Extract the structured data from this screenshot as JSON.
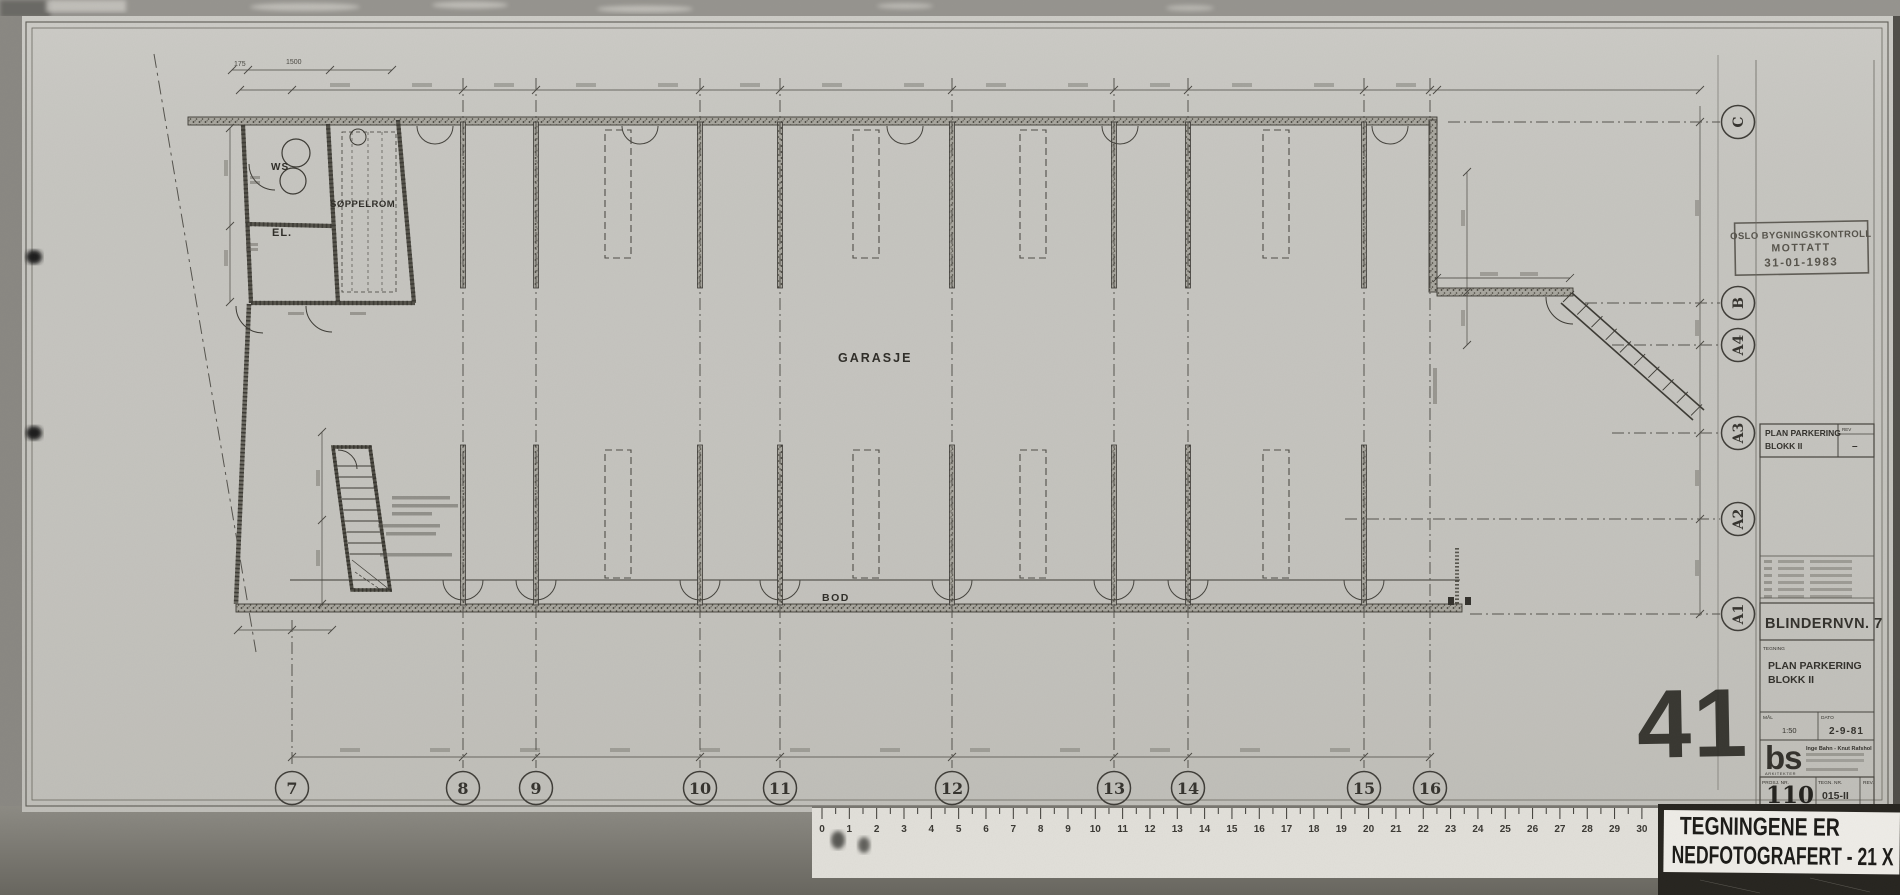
{
  "sheet": {
    "rooms": {
      "ws": "WS",
      "el": "EL.",
      "soppelrom": "SØPPELROM",
      "garasje": "GARASJE",
      "bod": "BOD"
    },
    "grid": {
      "columns": [
        {
          "label": "7",
          "x": 292
        },
        {
          "label": "8",
          "x": 463
        },
        {
          "label": "9",
          "x": 536
        },
        {
          "label": "10",
          "x": 700
        },
        {
          "label": "11",
          "x": 780
        },
        {
          "label": "12",
          "x": 952
        },
        {
          "label": "13",
          "x": 1114
        },
        {
          "label": "14",
          "x": 1188
        },
        {
          "label": "15",
          "x": 1364
        },
        {
          "label": "16",
          "x": 1430
        }
      ],
      "rows": [
        {
          "label": "C",
          "y": 122,
          "x0": 1448
        },
        {
          "label": "B",
          "y": 303,
          "x0": 1585
        },
        {
          "label": "A4",
          "y": 345,
          "x0": 1612
        },
        {
          "label": "A3",
          "y": 433,
          "x0": 1612
        },
        {
          "label": "A2",
          "y": 519,
          "x0": 1345
        },
        {
          "label": "A1",
          "y": 614,
          "x0": 1470
        }
      ]
    },
    "dims": {
      "d175": "175",
      "d1500": "1500"
    },
    "stamp": {
      "line1": "OSLO BYGNINGSKONTROLL",
      "line2": "MOTTATT",
      "line3": "31-01-1983"
    },
    "rev_box": {
      "title1": "PLAN PARKERING",
      "title2": "BLOKK II",
      "rev_label": "REV",
      "rev_value": "–"
    },
    "title_block": {
      "address": "BLINDERNVN. 7",
      "drawing_label": "TEGNING",
      "title1": "PLAN PARKERING",
      "title2": "BLOKK II",
      "scale_label": "MÅL",
      "scale_value": "1:50",
      "date_label": "DATO",
      "date_value": "2-9-81",
      "logo": "bs",
      "firm": "Inge Bahn - Knut Rafshol",
      "firm_sub": "ARKITEKTER",
      "proj_label": "PROSJ. NR.",
      "proj_value": "110",
      "dwg_label": "TEGN. NR.",
      "dwg_value": "015-II",
      "rev_label": "REV."
    },
    "photo_number": "41"
  },
  "ruler": {
    "numbers": [
      "0",
      "1",
      "2",
      "3",
      "4",
      "5",
      "6",
      "7",
      "8",
      "9",
      "10",
      "11",
      "12",
      "13",
      "14",
      "15",
      "16",
      "17",
      "18",
      "19",
      "20",
      "21",
      "22",
      "23",
      "24",
      "25",
      "26",
      "27",
      "28",
      "29",
      "30"
    ]
  },
  "footer_label": {
    "line1": "TEGNINGENE ER",
    "line2": "NEDFOTOGRAFERT - 21 X"
  }
}
